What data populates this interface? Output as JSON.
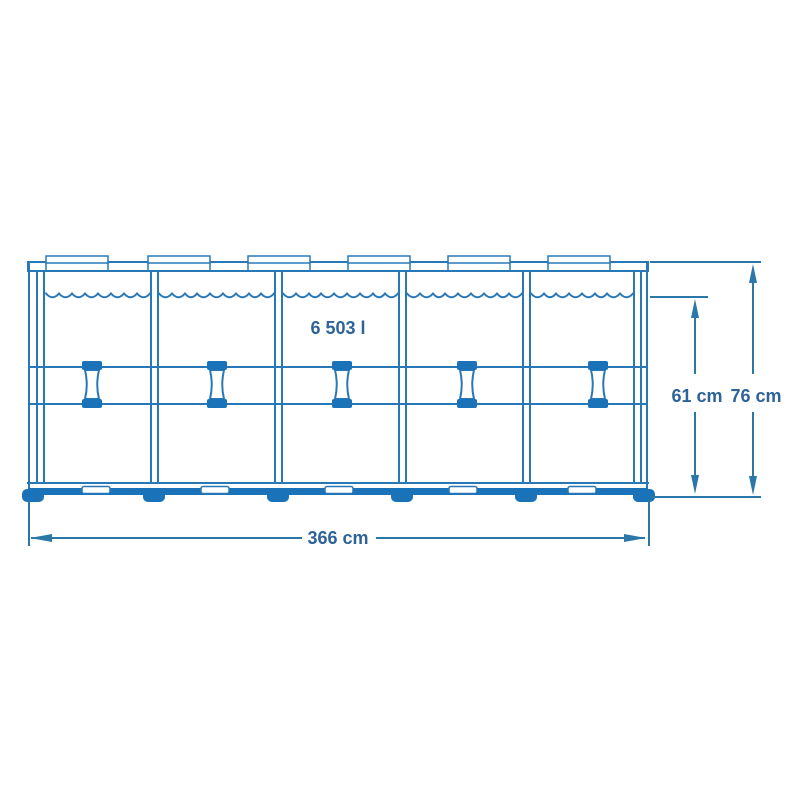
{
  "diagram": {
    "type": "pool-frame-dimension-diagram",
    "capacity_label": "6 503 l",
    "dimensions": {
      "width_label": "366 cm",
      "water_height_label": "61 cm",
      "total_height_label": "76 cm"
    }
  },
  "colors": {
    "frame": "#2878b8",
    "fill": "#1a72b8",
    "dim": "#2b78a8",
    "text": "#2d6399",
    "bg": "#ffffff"
  }
}
